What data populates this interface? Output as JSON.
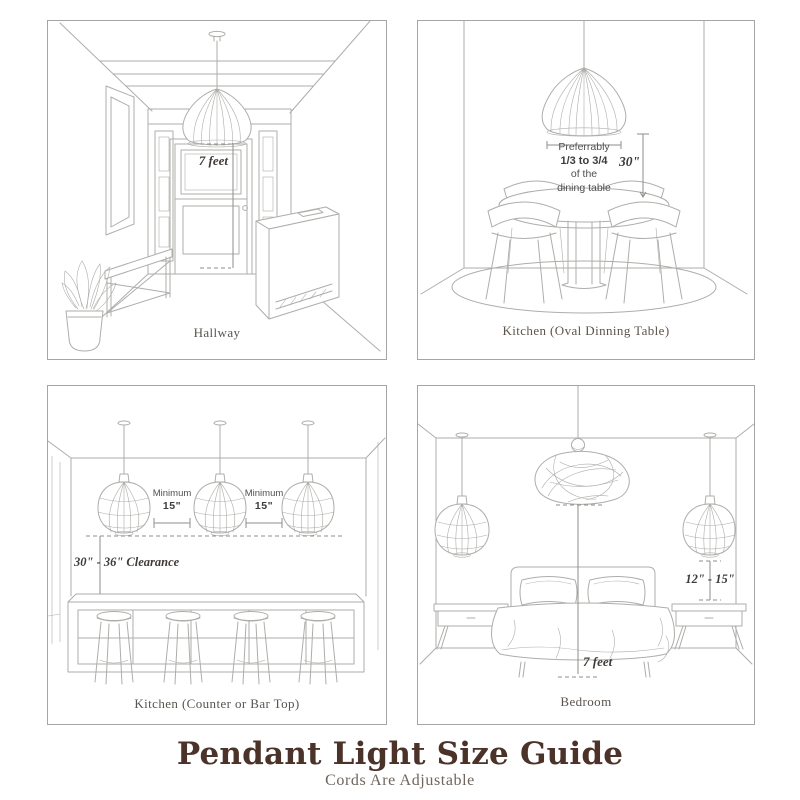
{
  "footer": {
    "title": "Pendant Light Size Guide",
    "subtitle": "Cords Are Adjustable"
  },
  "panels": {
    "hallway": {
      "caption": "Hallway",
      "height_label": "7 feet"
    },
    "dining_table": {
      "caption": "Kitchen (Oval Dinning Table)",
      "note": [
        "Preferrably",
        "1/3 to 3/4",
        "of the",
        "dining table"
      ],
      "drop_label": "30\""
    },
    "counter": {
      "caption": "Kitchen (Counter or Bar Top)",
      "min_label": "Minimum",
      "min_value": "15\"",
      "clearance_label": "30\" - 36\" Clearance"
    },
    "bedroom": {
      "caption": "Bedroom",
      "side_label": "12\" - 15\"",
      "height_label": "7 feet"
    }
  },
  "colors": {
    "background": "#ffffff",
    "line": "#aeadaa",
    "measure_line": "#8f8d8a",
    "panel_border": "#a5a5a5",
    "caption": "#5a544d",
    "measure_text": "#3f3b38",
    "note_text": "#4f4f4f",
    "title": "#4b3329",
    "subtitle": "#6e655c"
  }
}
